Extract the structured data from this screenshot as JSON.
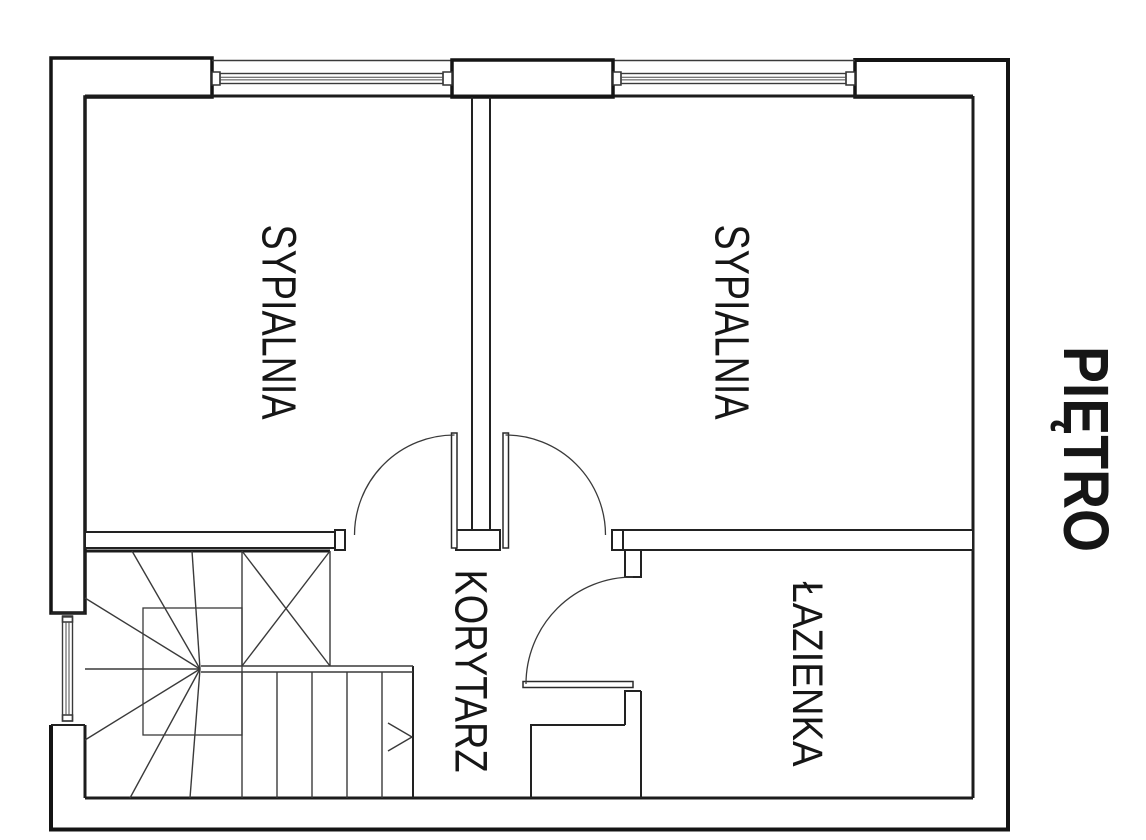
{
  "floor_plan": {
    "floor_label": {
      "text": "PIĘTRO"
    },
    "rooms": [
      {
        "id": "sypialnia-1",
        "label": "SYPIALNIA"
      },
      {
        "id": "sypialnia-2",
        "label": "SYPIALNIA"
      },
      {
        "id": "korytarz",
        "label": "KORYTARZ"
      },
      {
        "id": "lazienka",
        "label": "ŁAZIENKA"
      }
    ],
    "features": {
      "windows": [
        "top-window-left",
        "top-window-right",
        "side-window-left"
      ],
      "doors": [
        "bedroom-1-door",
        "bedroom-2-door",
        "bathroom-door"
      ],
      "stairs": "winder-staircase-with-direction-arrow"
    },
    "colors": {
      "line": "#1c1c1c",
      "background": "#ffffff",
      "text": "#161616"
    }
  }
}
